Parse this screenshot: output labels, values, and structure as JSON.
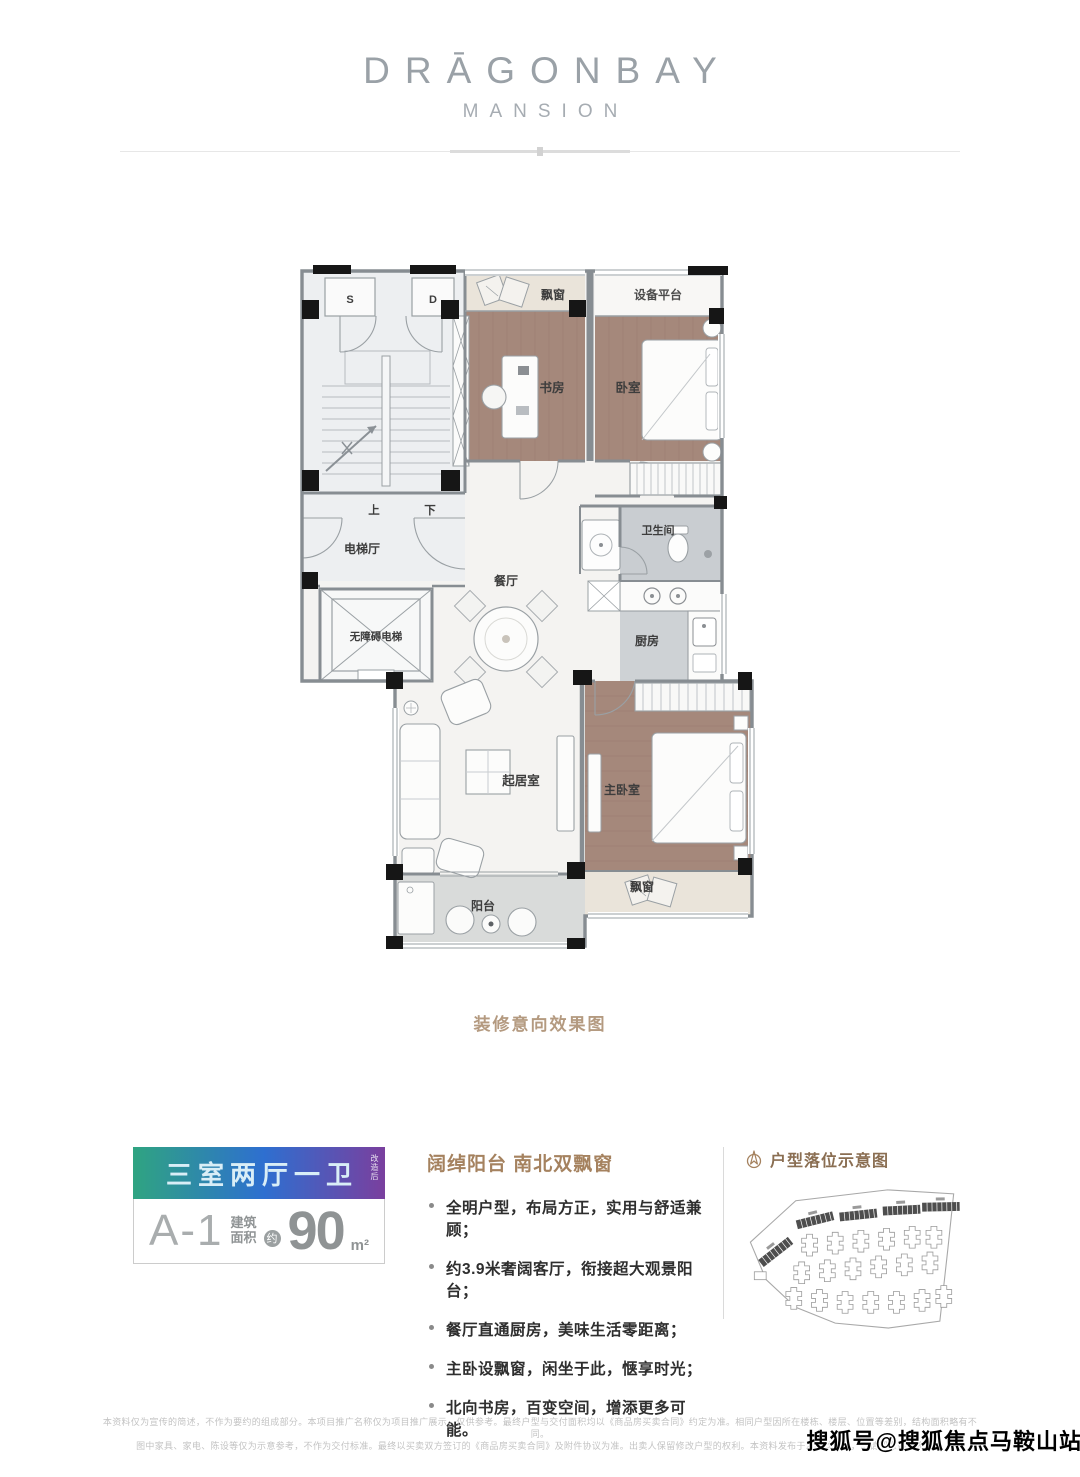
{
  "brand": {
    "name": "DRĀGONBAY",
    "subtitle": "MANSION"
  },
  "floorplan": {
    "caption": "装修意向效果图",
    "rooms": {
      "stair_s": "S",
      "stair_d": "D",
      "up": "上",
      "down": "下",
      "elevator_hall": "电梯厅",
      "accessible_elevator": "无障碍电梯",
      "bay_window_top": "飘窗",
      "equipment_platform": "设备平台",
      "study": "书房",
      "bedroom": "卧室",
      "bathroom": "卫生间",
      "kitchen": "厨房",
      "dining": "餐厅",
      "living_room": "起居室",
      "master_bedroom": "主卧室",
      "balcony": "阳台",
      "bay_window_bottom": "飘窗"
    }
  },
  "unit_badge": {
    "layout_tag": "三室两厅一卫",
    "layout_tag_note": "改造后",
    "unit_code": "A-1",
    "area_label_top": "建筑",
    "area_label_bottom": "面积",
    "area_approx": "约",
    "area_value": "90",
    "area_unit": "m²",
    "gradient_left": "#2fa481",
    "gradient_mid": "#2e6fd0",
    "gradient_right": "#7a3f9e"
  },
  "features": {
    "heading": "阔绰阳台 南北双飘窗",
    "items": [
      "全明户型，布局方正，实用与舒适兼顾；",
      "约3.9米奢阔客厅，衔接超大观景阳台；",
      "餐厅直通厨房，美味生活零距离；",
      "主卧设飘窗，闲坐于此，惬享时光；",
      "北向书房，百变空间，增添更多可能。"
    ]
  },
  "siteplan": {
    "heading": "户型落位示意图"
  },
  "footer": {
    "disclaimer_line1": "本资料仅为宣传的简述，不作为要约的组成部分。本项目推广名称仅为项目推广展示，仅供参考。最终户型与交付面积均以《商品房买卖合同》约定为准。相同户型因所在楼栋、楼层、位置等差别，结构面积略有不同。",
    "disclaimer_line2": "图中家具、家电、陈设等仅为示意参考，不作为交付标准。最终以买卖双方签订的《商品房买卖合同》及附件协议为准。出卖人保留修改户型的权利。本资料发布于2020年7月，敬请留意最新资料。",
    "watermark": "搜狐号@搜狐焦点马鞍山站"
  }
}
